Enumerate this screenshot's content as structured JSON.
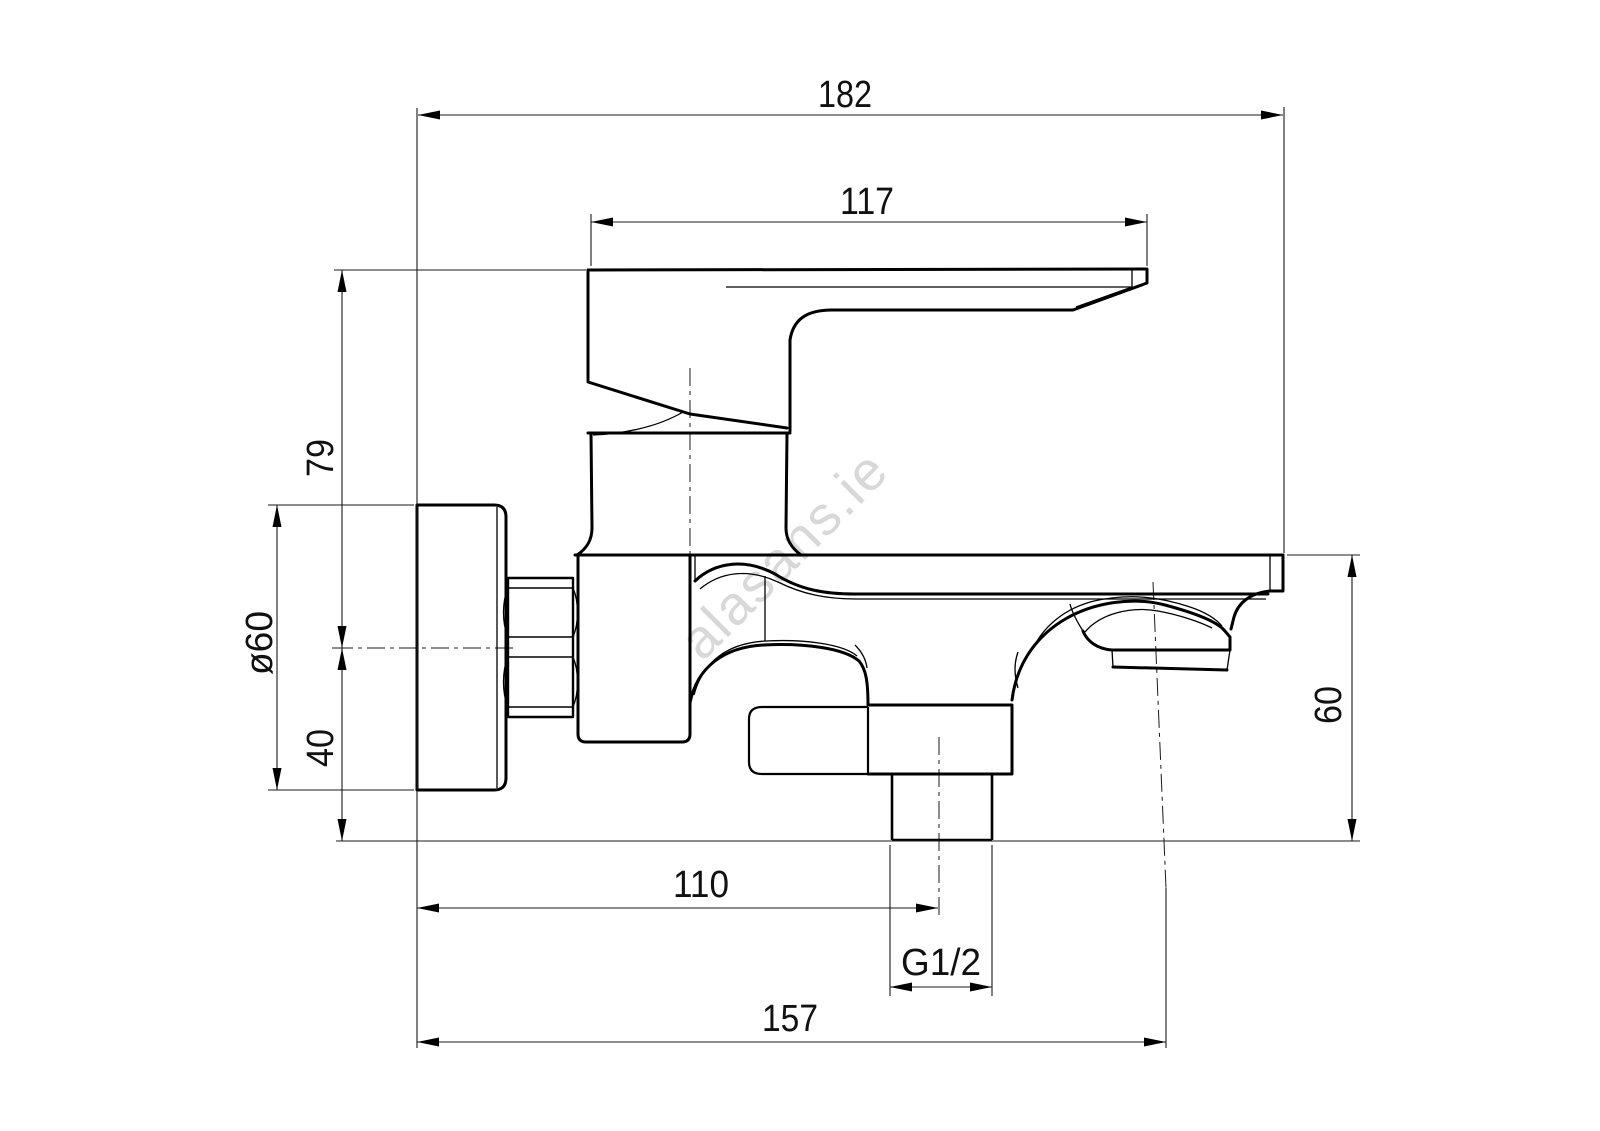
{
  "watermark": "alasans.ie",
  "dimensions": {
    "total_width": "182",
    "handle_length": "117",
    "height_above_axis": "79",
    "flange_diameter": "ø60",
    "axis_to_flange_bottom": "40",
    "spout_drop": "60",
    "axis_to_outlet": "110",
    "outlet_thread": "G1/2",
    "wall_to_spout": "157"
  },
  "colors": {
    "line": "#000000",
    "watermark": "#d8d8d8",
    "background": "#ffffff"
  }
}
